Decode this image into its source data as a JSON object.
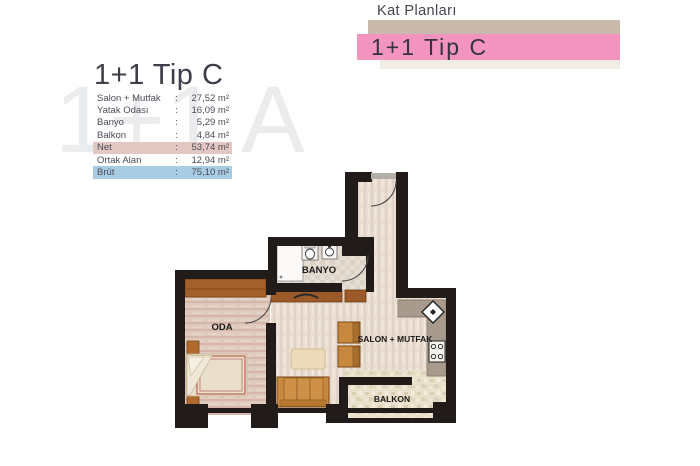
{
  "header": {
    "kicker": "Kat Planları",
    "banner_title": "1+1 Tip C",
    "banner_pink_color": "#f294bd",
    "banner_tan_color": "#c8b9ab",
    "banner_cream_color": "#f2ede4"
  },
  "watermark": "1+1 A",
  "info": {
    "title": "1+1 Tip C",
    "colon": ":",
    "rows": [
      {
        "label": "Salon + Mutfak",
        "value": "27,52 m²",
        "highlight": "none"
      },
      {
        "label": "Yatak Odası",
        "value": "16,09 m²",
        "highlight": "none"
      },
      {
        "label": "Banyo",
        "value": "5,29 m²",
        "highlight": "none"
      },
      {
        "label": "Balkon",
        "value": "4,84 m²",
        "highlight": "none"
      },
      {
        "label": "Net",
        "value": "53,74 m²",
        "highlight": "pink"
      },
      {
        "label": "Ortak Alan",
        "value": "12,94 m²",
        "highlight": "none"
      },
      {
        "label": "Brüt",
        "value": "75,10 m²",
        "highlight": "blue"
      }
    ],
    "highlight_pink_color": "#e3c7c2",
    "highlight_blue_color": "#a7cce4"
  },
  "plan": {
    "wall_color": "#211c19",
    "rooms": [
      {
        "name": "oda",
        "label": "ODA"
      },
      {
        "name": "banyo",
        "label": "BANYO"
      },
      {
        "name": "salon-mutfak",
        "label": "SALON + MUTFAK"
      },
      {
        "name": "balkon",
        "label": "BALKON"
      }
    ]
  }
}
